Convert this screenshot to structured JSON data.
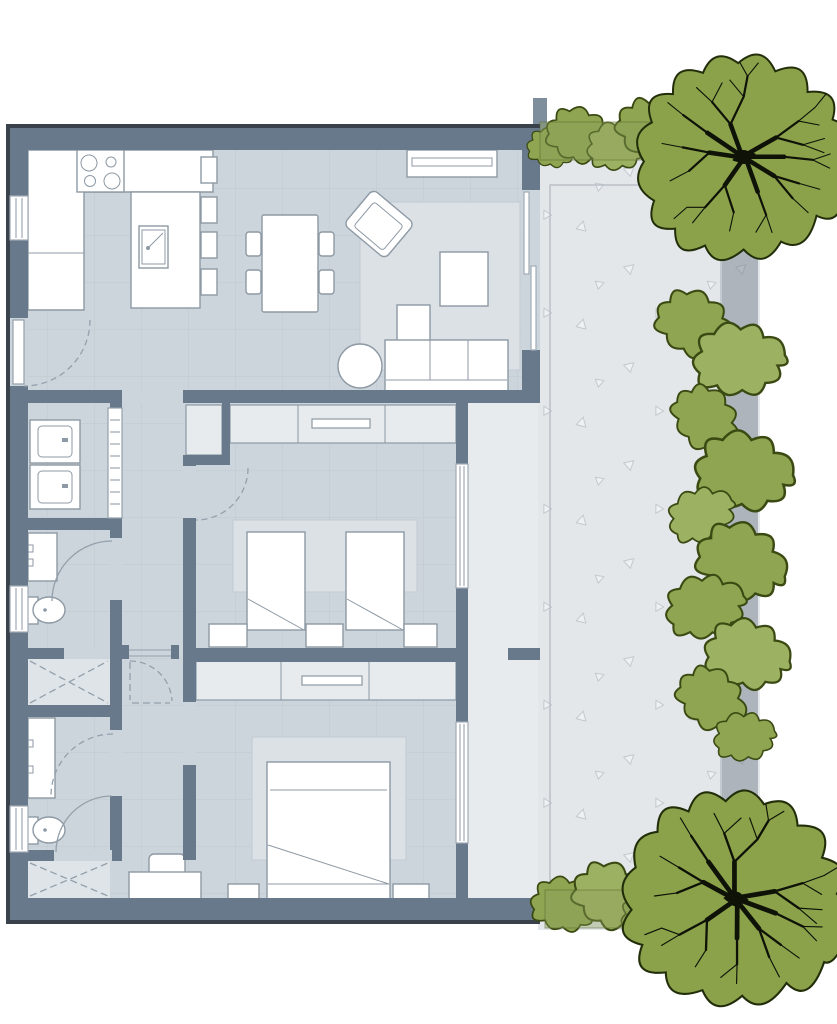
{
  "meta": {
    "label": "Apartment floor plan with garden terrace, hedges and trees"
  },
  "colors": {
    "background": "#ffffff",
    "wall": "#68798b",
    "wall-edge": "#39414a",
    "floor": "#cdd5dc",
    "grid-line": "#bec8d1",
    "rug": "#dce1e6",
    "rug-line": "#c6cdd4",
    "furn-fill": "#ffffff",
    "furn-stroke": "#8d99a4",
    "wardrobe-fill": "#e7ebee",
    "shower-floor": "#dfe4e8",
    "glass": "#a0abb5",
    "door-arc": "#93a0ab",
    "terrace": "#e3e7ea",
    "terrace-strip": "#e8ebee",
    "speckle": "#c3c9cf",
    "speckle-fill": "#eef1f3",
    "patio-line": "#b9c0c7",
    "gray-band": "rgba(121,130,139,0.50)",
    "hedge-band": "rgba(141,160,92,0.38)",
    "hedge-stroke": "rgba(90,106,48,0.55)",
    "shrub-fill": "#8fa551",
    "shrub-fill-alt": "#9db163",
    "shrub-stroke": "#3b4a12",
    "tree-fill": "#8ba24b",
    "tree-stroke": "#222d09",
    "branch": "#0e1207",
    "pillar": "#7e8e9c"
  },
  "legend": {
    "rooms": [
      "kitchen",
      "dining-area",
      "living-room",
      "laundry-room",
      "bathroom-1",
      "shower-room-1",
      "hallway",
      "bedroom-1",
      "bathroom-2",
      "shower-room-2",
      "master-bedroom",
      "terrace",
      "garden"
    ],
    "kitchen": [
      "stove-4-burners",
      "u-shaped-counter",
      "island-sink",
      "bar-stools-x4"
    ],
    "dining": [
      "table",
      "chairs-x4"
    ],
    "living": [
      "tv-console",
      "tv",
      "armchair",
      "rug",
      "coffee-table",
      "sofa",
      "chaise",
      "round-side-table",
      "sliding-glass-door"
    ],
    "laundry": [
      "washer",
      "dryer",
      "folding-door"
    ],
    "bathrooms": [
      "vanity-sink-x2",
      "toilet-x2",
      "walk-in-shower-x2"
    ],
    "bedroom1": [
      "wardrobe-with-rail",
      "twin-bed-x2",
      "nightstand-x3",
      "window"
    ],
    "master": [
      "wardrobe-with-rail",
      "double-bed",
      "nightstand-x2",
      "desk",
      "desk-chair",
      "window"
    ],
    "outdoor": [
      "paved-terrace",
      "patio-border",
      "edge-band",
      "hedge-band-top",
      "hedge-band-bottom",
      "shrub-row",
      "tree-x2"
    ],
    "windows_count": 7,
    "door_arcs_count": 7
  }
}
